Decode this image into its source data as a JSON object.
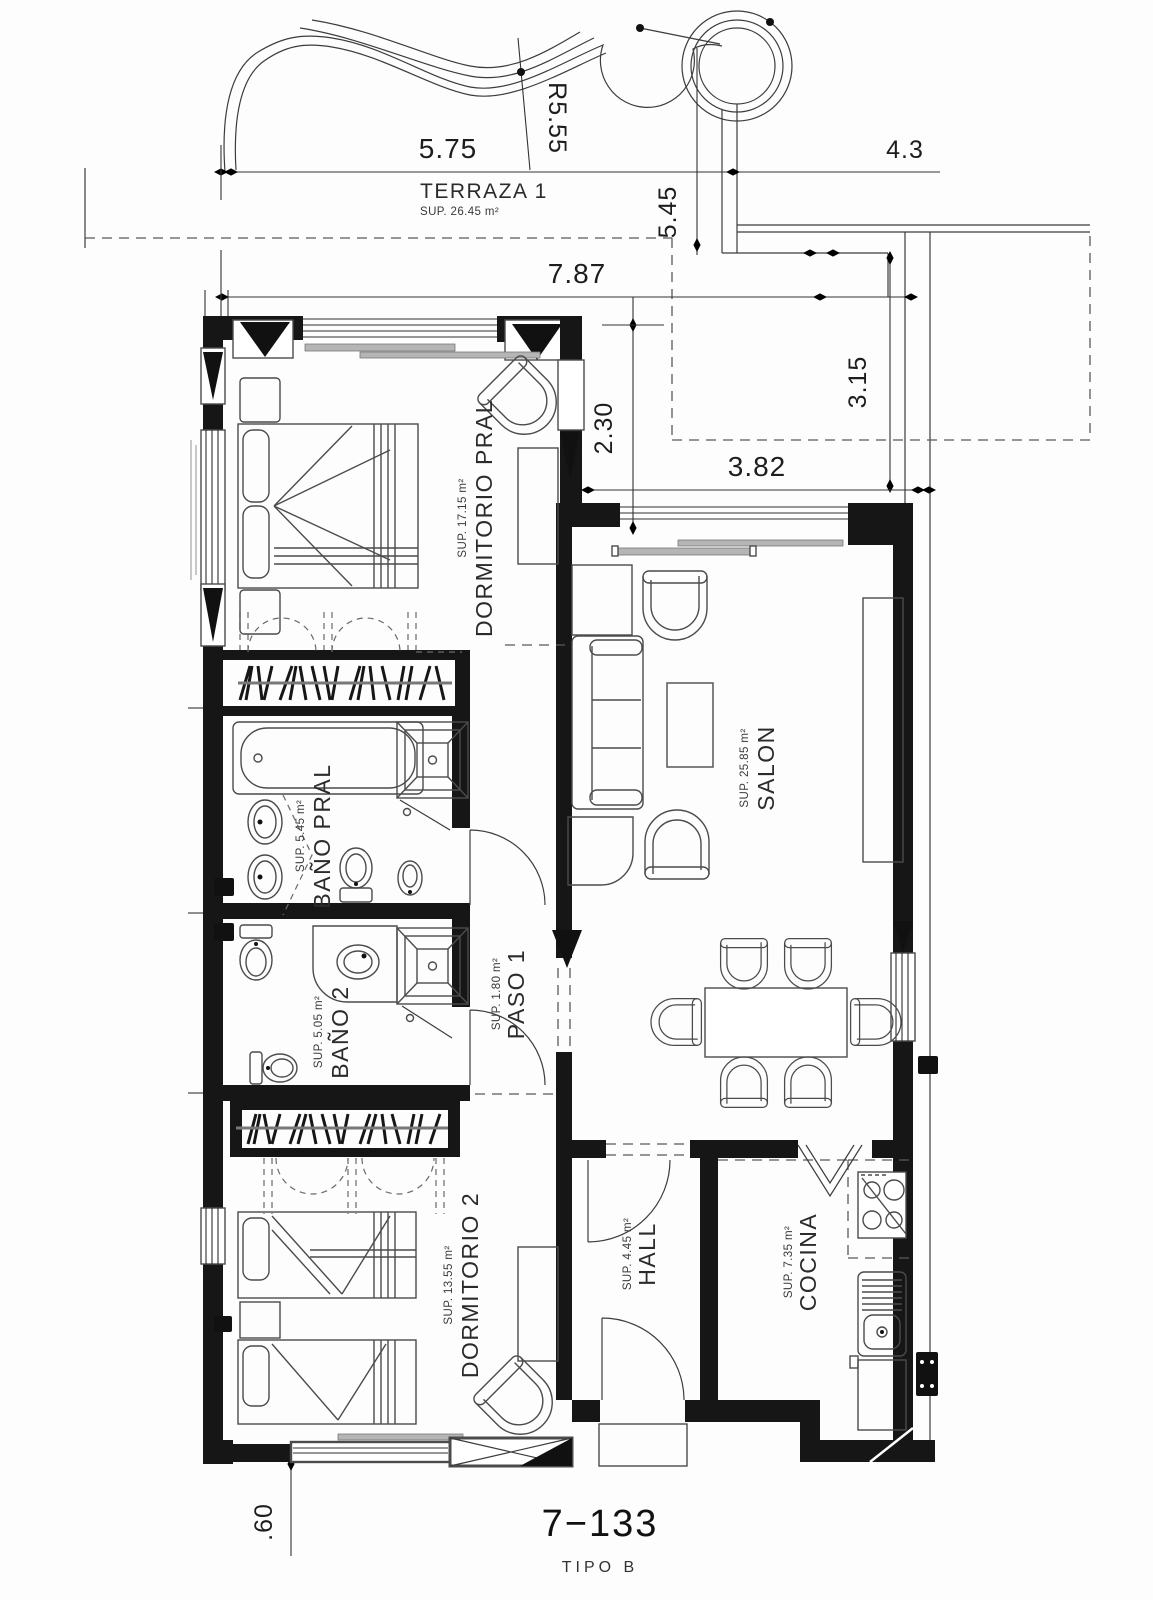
{
  "plan": {
    "title": "7−133",
    "subtitle": "TIPO B",
    "rooms": [
      {
        "name": "TERRAZA 1",
        "area": "SUP. 26.45 m²"
      },
      {
        "name": "DORMITORIO PRAL",
        "area": "SUP. 17.15 m²"
      },
      {
        "name": "SALON",
        "area": "SUP. 25.85 m²"
      },
      {
        "name": "BAÑO PRAL",
        "area": "SUP. 5.45 m²"
      },
      {
        "name": "PASO 1",
        "area": "SUP. 1.80 m²"
      },
      {
        "name": "BAÑO 2",
        "area": "SUP. 5.05 m²"
      },
      {
        "name": "DORMITORIO 2",
        "area": "SUP. 13.55 m²"
      },
      {
        "name": "HALL",
        "area": "SUP. 4.45 m²"
      },
      {
        "name": "COCINA",
        "area": "SUP. 7.35 m²"
      }
    ],
    "dimensions": {
      "top_width": "5.75",
      "radius": "R5.55",
      "top_right_width": "4.3",
      "terrace_depth": "5.45",
      "mid_width": "7.87",
      "salon_offset": "2.30",
      "terrace2_depth": "3.15",
      "terrace2_width": "3.82",
      "bottom_offset": ".60"
    }
  }
}
